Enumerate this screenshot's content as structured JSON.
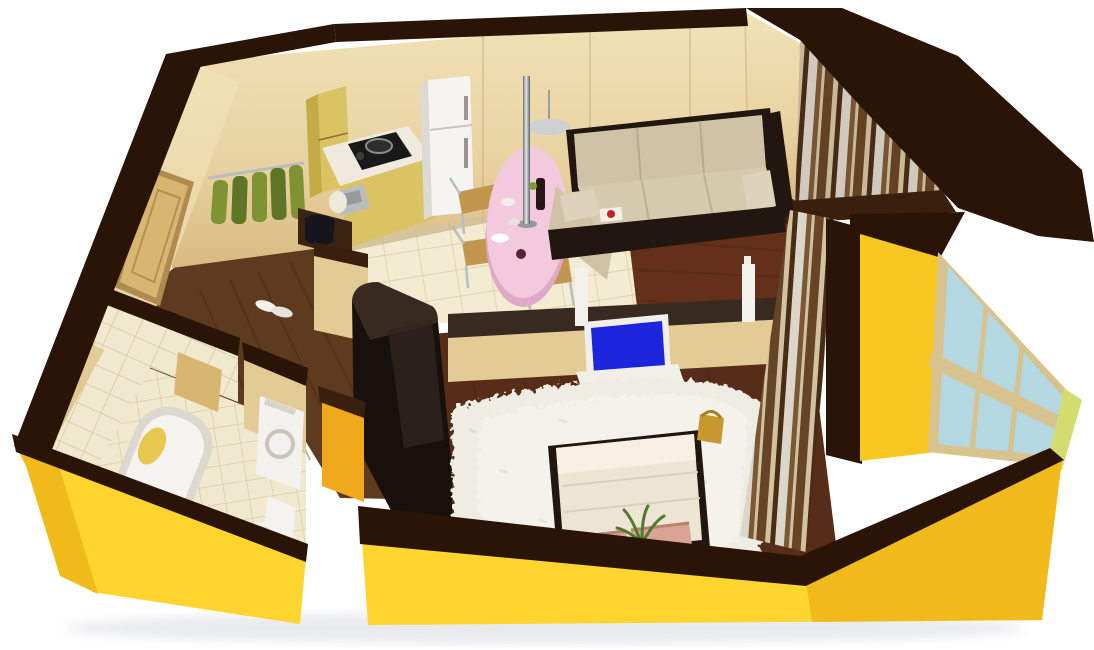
{
  "scene": {
    "type": "3d-floor-plan-render",
    "description": "Isometric cutaway 3D render of a one-bedroom apartment floor plan with yellow exterior walls and dark chocolate wall caps on a white background",
    "view": "bird's-eye three-quarter cutaway"
  },
  "rooms": {
    "hallway": {
      "label": "entry hallway with coat rack and dark wood floor"
    },
    "kitchen": {
      "label": "kitchen-dining area with beige tile floor"
    },
    "living": {
      "label": "living room with corner sofa and dark wood floor"
    },
    "bedroom": {
      "label": "bedroom with bed, shag rug and TV"
    },
    "bathroom": {
      "label": "bathroom with tub, sink, toilet and washing machine"
    },
    "balconyTop": {
      "label": "curtained balcony behind living room"
    },
    "balconyRight": {
      "label": "glazed balcony with windows right of bedroom"
    }
  },
  "furniture": {
    "fridge": {
      "label": "white refrigerator"
    },
    "kitchenset": {
      "label": "kitchen cabinets with cooktop and sink"
    },
    "diningTable": {
      "label": "pink oval dining table with support pole"
    },
    "chairs": {
      "label": "wooden dining chairs"
    },
    "lamp": {
      "label": "pendant lamp disk"
    },
    "sofa": {
      "label": "beige corner sofa with dark wood frame"
    },
    "tv": {
      "label": "flat TV with blue screen on white stand"
    },
    "rug": {
      "label": "white shag rug"
    },
    "bed": {
      "label": "double bed with white duvet and pink pillows"
    },
    "wardrobe": {
      "label": "black glossy wardrobe partition"
    },
    "coatRack": {
      "label": "coat rail with green coats"
    },
    "entranceDoor": {
      "label": "entrance door"
    },
    "bathtub": {
      "label": "white bathtub with yellow towel"
    },
    "vanity": {
      "label": "dark vanity with white vessel sink"
    },
    "toilet": {
      "label": "white toilet"
    },
    "washer": {
      "label": "white washing machine"
    },
    "curtains": {
      "label": "brown and cream striped curtains"
    },
    "balconyWindow": {
      "label": "balcony window with light blue glass"
    },
    "plant": {
      "label": "small green plant"
    },
    "basket": {
      "label": "gold basket on bedroom floor"
    }
  },
  "colors": {
    "bg": "#ffffff",
    "capDark": "#2a1307",
    "capDark2": "#3a1f0e",
    "capGray": "#392a21",
    "yellowFace": "#fed42f",
    "yellowShade": "#f0bb1a",
    "yellowInner": "#f0a81c",
    "balconyYellow": "#f6c81f",
    "wallBeige": "#ecd8a8",
    "wallBeigeDark": "#d9bd85",
    "wallTan": "#e3cb96",
    "wallSeam": "#c9ab77",
    "tileFloor": "#f3ecd2",
    "tileLine": "#d9cba4",
    "bathTile": "#f0e9cf",
    "grout": "#d6c69c",
    "woodHall": "#5e3a1f",
    "woodLiving": "#643019",
    "woodBed": "#572c18",
    "woodStreak": "#3f2310",
    "rugWhite": "#efece3",
    "rugShade": "#d8d3c5",
    "sofaBeige": "#cfc2a6",
    "sofaLight": "#ddd2bc",
    "sofaSeat": "#d6caae",
    "frameDark": "#221710",
    "tablePink": "#f3c9de",
    "tablePinkSide": "#dfa9c8",
    "chairWood": "#c2964f",
    "fridgeWhite": "#f6f4f1",
    "fridgeSide": "#ddd9d3",
    "applianceWhite": "#f4f2ee",
    "applianceShade": "#dedad2",
    "cabinetWood": "#d9c363",
    "cabinetWoodDark": "#c4ab45",
    "counterWhite": "#efeadd",
    "stoveBlack": "#191918",
    "steel": "#b9bcc0",
    "wardrobeBlack": "#17100c",
    "wardrobeSheen": "#31261e",
    "curtainBrown": "#6d4a29",
    "curtainBrown2": "#85603a",
    "curtainCream": "#e9d9b6",
    "curtainWhite": "#f3eee4",
    "curtainDark": "#4a2f16",
    "windowGlass": "#b4d8e1",
    "windowFrame": "#d8c28e",
    "limeEdge": "#d3dc6e",
    "tvBlue": "#1c24dc",
    "tvWhite": "#f1efe9",
    "doorTan": "#d8b670",
    "coatGreen": "#7f9332",
    "coatGreenDark": "#5e7526",
    "pillowPink": "#d9a493",
    "bedWhite": "#ece5d3",
    "bedLight": "#f5f0e2",
    "toiletWhite": "#f5f3ef",
    "bagDark": "#22242e",
    "benchDark": "#3a2312",
    "poleGray": "#8d9094",
    "lampGray": "#cfd0d2",
    "bottleDark": "#2a1418",
    "bookRed": "#c42020",
    "orangeItem": "#d98a28",
    "plantGreen": "#4d7a2c",
    "towelYellow": "#e8c84e",
    "basketGold": "#c8972f"
  }
}
